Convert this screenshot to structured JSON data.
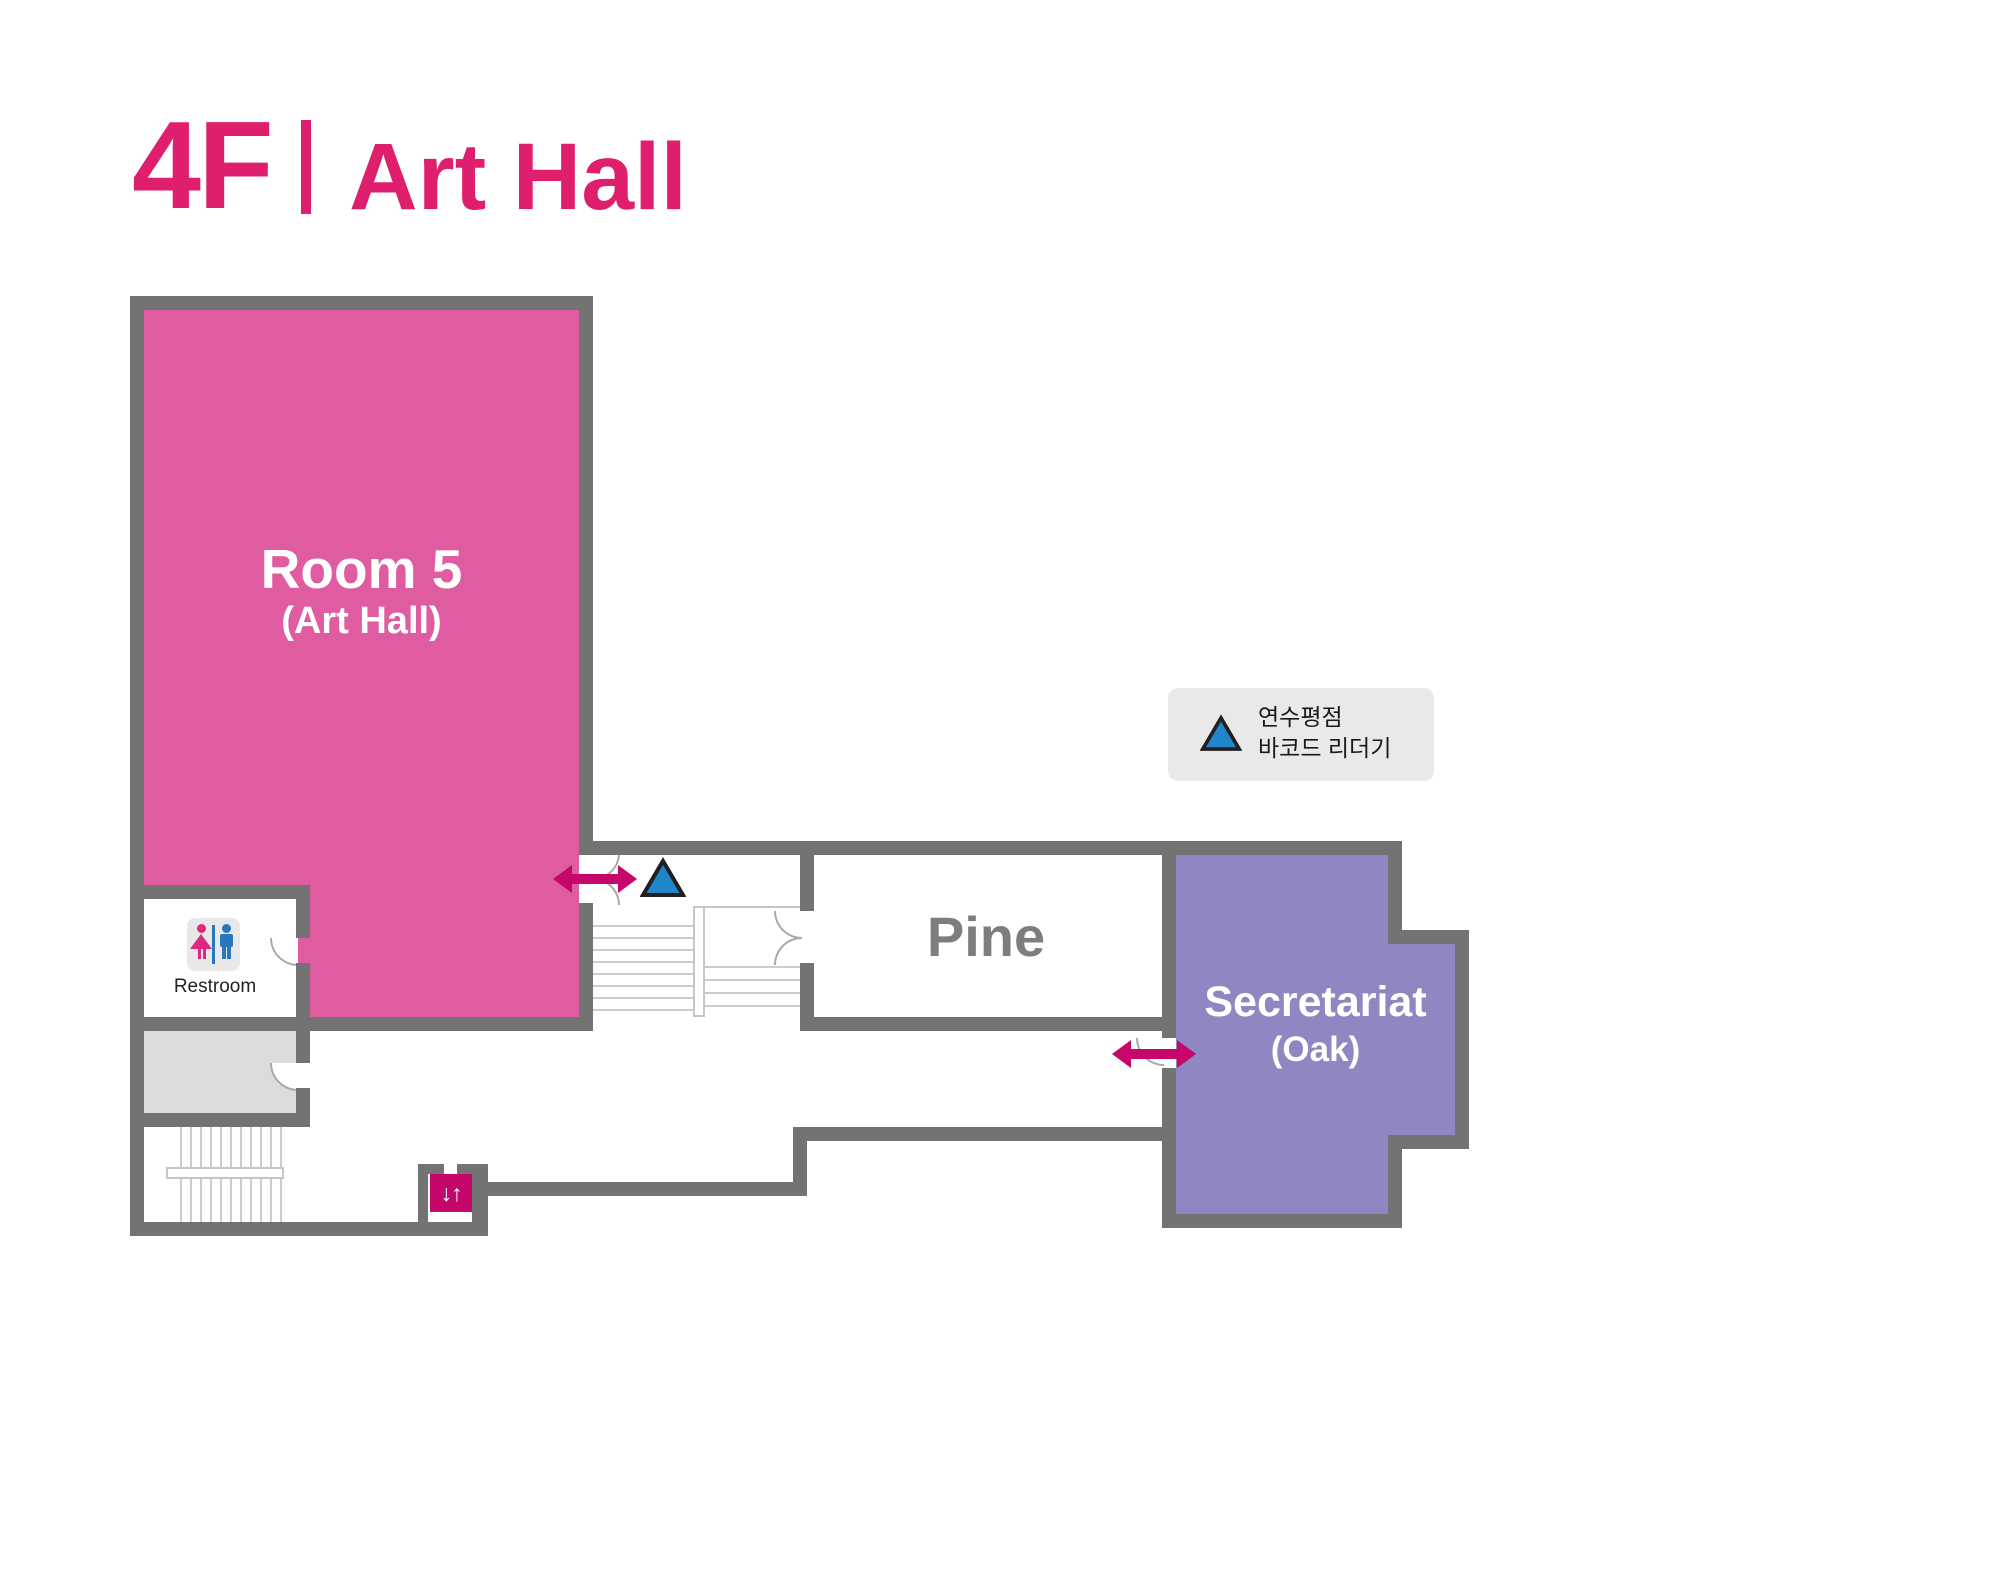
{
  "header": {
    "floor": "4F",
    "hall": "Art Hall",
    "accent_color": "#DF1E6E"
  },
  "rooms": {
    "room5": {
      "name": "Room 5",
      "subtitle": "(Art Hall)",
      "fill": "#DE5C9F"
    },
    "pine": {
      "name": "Pine",
      "fill": "#FFFFFF",
      "label_color": "#7D7D7D"
    },
    "secretariat": {
      "name": "Secretariat",
      "subtitle": "(Oak)",
      "fill": "#8E87C1"
    },
    "restroom": {
      "label": "Restroom",
      "female_color": "#E0267E",
      "male_color": "#2777BD"
    },
    "utility_room": {
      "fill": "#DBDBDB"
    }
  },
  "legend": {
    "line1": "연수평점",
    "line2": "바코드 리더기",
    "marker": "barcode-reader-triangle",
    "marker_fill": "#1F86C9",
    "marker_outline": "#231F20",
    "background": "#E9E9E9"
  },
  "elevator": {
    "glyph": "↓↑",
    "fill": "#C5076B"
  },
  "markers": {
    "entrance_arrow_color": "#C5076B"
  },
  "walls": {
    "color": "#737373"
  }
}
